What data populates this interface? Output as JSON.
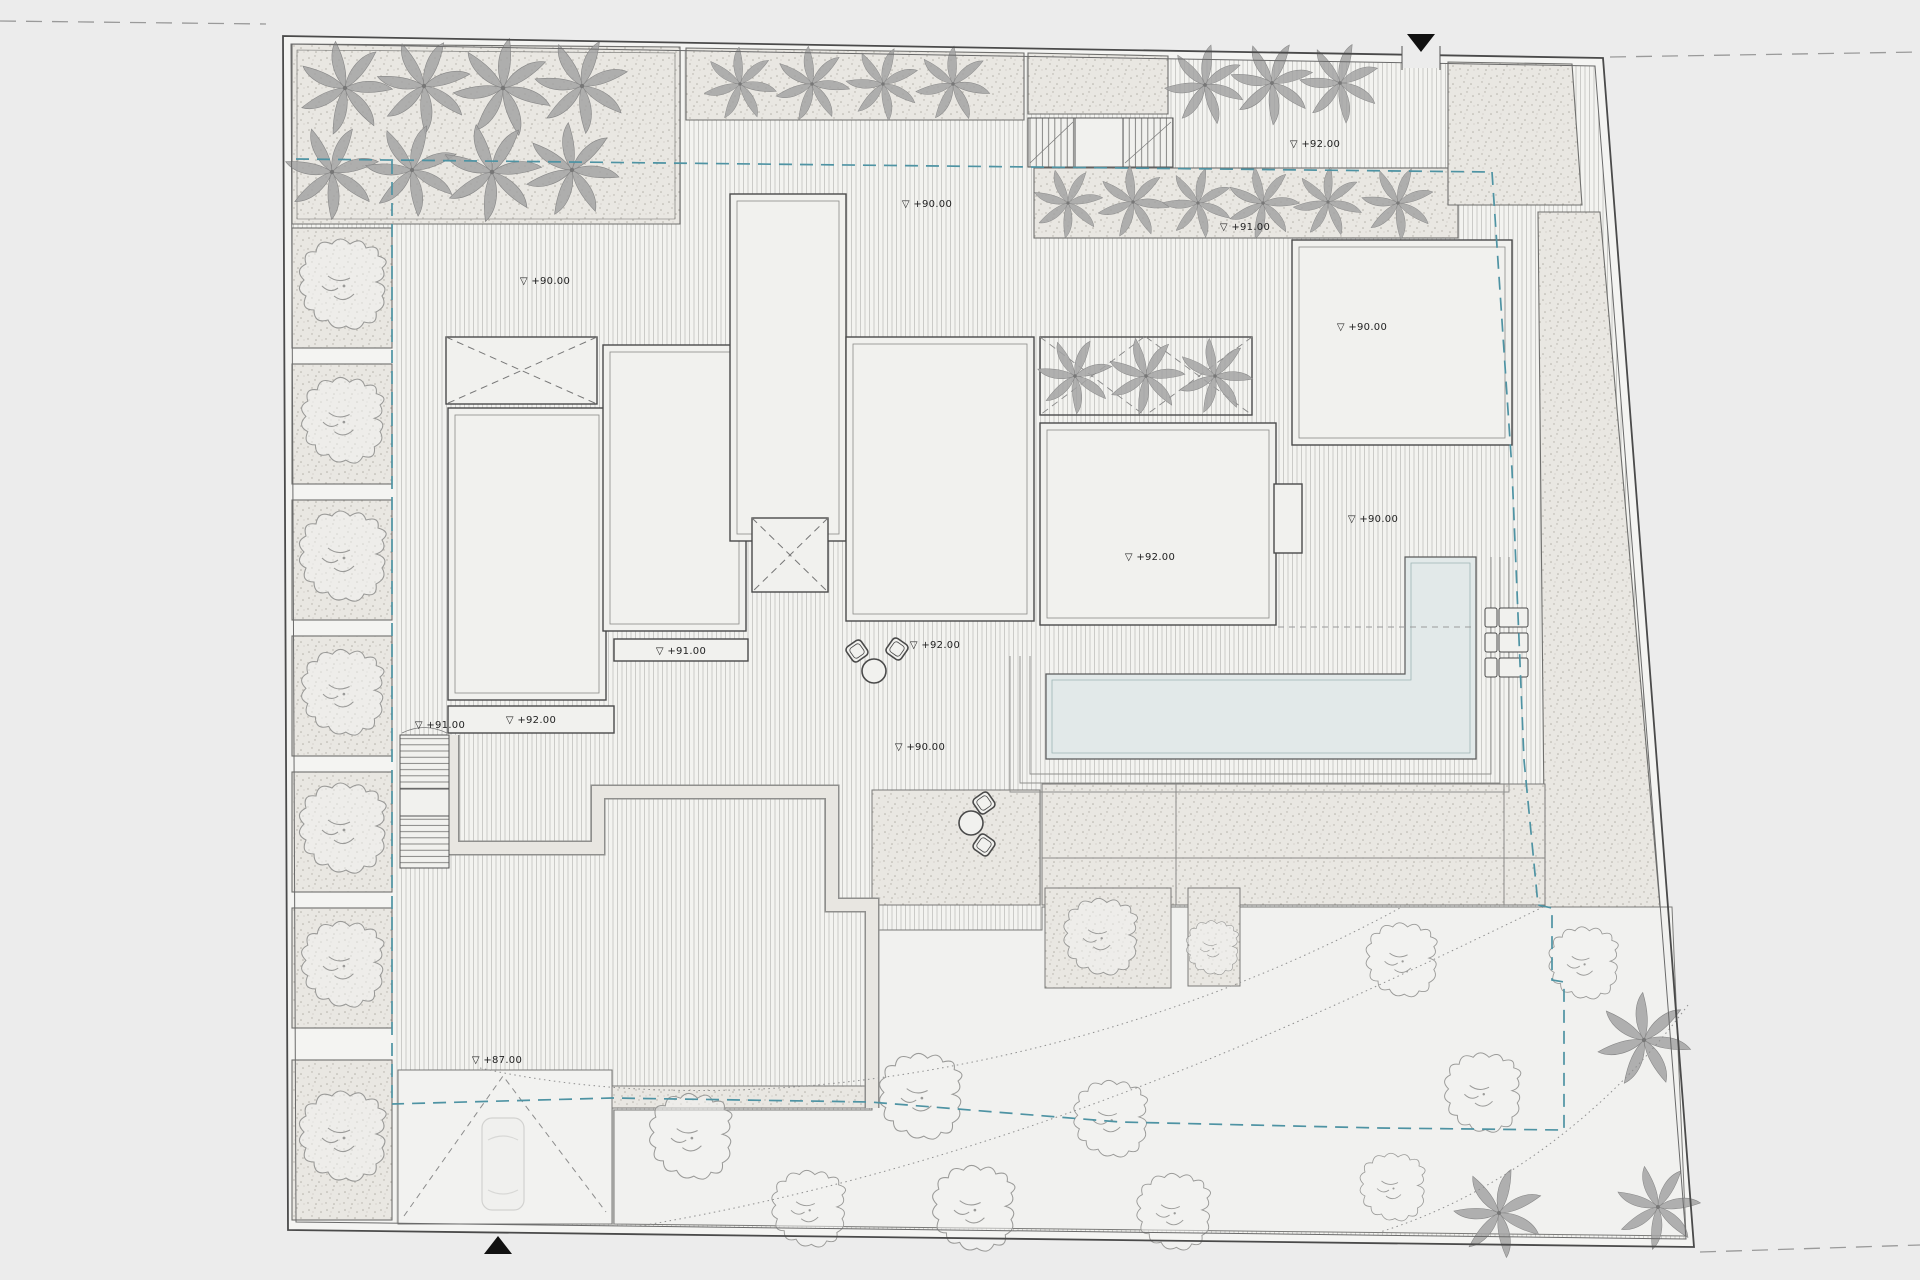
{
  "document": {
    "title": "Site Plan — Roof Level",
    "background": "#ececec"
  },
  "colors": {
    "paper": "#ececec",
    "site": "#f4f4f2",
    "hatch_line": "#c7c7c4",
    "stipple_bg": "#e9e7e2",
    "stipple_dot": "#b3b0a8",
    "roof": "#f1f1ee",
    "line_dark": "#4a4a4a",
    "line_mid": "#8a8a88",
    "pool_water": "#e2e9e9",
    "setback_teal": "#4e93a3",
    "street_dash": "#9a9a9a",
    "marker_black": "#111111"
  },
  "markers": {
    "north_entry": "▼",
    "south_entry": "▲"
  },
  "level_markers": [
    {
      "x": 545,
      "y": 284,
      "text": "▽ +90.00"
    },
    {
      "x": 927,
      "y": 207,
      "text": "▽ +90.00"
    },
    {
      "x": 1315,
      "y": 147,
      "text": "▽ +92.00"
    },
    {
      "x": 1245,
      "y": 230,
      "text": "▽ +91.00"
    },
    {
      "x": 1362,
      "y": 330,
      "text": "▽ +90.00"
    },
    {
      "x": 531,
      "y": 723,
      "text": "▽ +92.00"
    },
    {
      "x": 681,
      "y": 654,
      "text": "▽ +91.00"
    },
    {
      "x": 935,
      "y": 648,
      "text": "▽ +92.00"
    },
    {
      "x": 1150,
      "y": 560,
      "text": "▽ +92.00"
    },
    {
      "x": 1373,
      "y": 522,
      "text": "▽ +90.00"
    },
    {
      "x": 440,
      "y": 728,
      "text": "▽ +91.00"
    },
    {
      "x": 497,
      "y": 1063,
      "text": "▽ +87.00"
    },
    {
      "x": 920,
      "y": 750,
      "text": "▽ +90.00"
    }
  ],
  "vegetation": {
    "palm_count": 27,
    "tree_count": 19,
    "palms": [
      [
        345,
        88,
        1.0,
        10
      ],
      [
        424,
        86,
        1.0,
        200
      ],
      [
        503,
        88,
        1.05,
        80
      ],
      [
        582,
        86,
        1.0,
        300
      ],
      [
        332,
        172,
        1.0,
        150
      ],
      [
        412,
        170,
        0.98,
        40
      ],
      [
        492,
        172,
        1.05,
        260
      ],
      [
        572,
        170,
        1.0,
        120
      ],
      [
        740,
        84,
        0.78,
        20
      ],
      [
        812,
        84,
        0.8,
        170
      ],
      [
        883,
        84,
        0.78,
        90
      ],
      [
        953,
        84,
        0.8,
        280
      ],
      [
        1068,
        203,
        0.74,
        0
      ],
      [
        1133,
        202,
        0.77,
        120
      ],
      [
        1198,
        203,
        0.74,
        240
      ],
      [
        1263,
        203,
        0.77,
        60
      ],
      [
        1328,
        202,
        0.74,
        180
      ],
      [
        1398,
        203,
        0.77,
        300
      ],
      [
        1205,
        85,
        0.85,
        30
      ],
      [
        1272,
        83,
        0.88,
        200
      ],
      [
        1340,
        83,
        0.85,
        90
      ],
      [
        1075,
        376,
        0.8,
        45
      ],
      [
        1146,
        376,
        0.82,
        160
      ],
      [
        1215,
        376,
        0.8,
        270
      ],
      [
        1644,
        1040,
        1.0,
        20
      ],
      [
        1499,
        1213,
        0.95,
        140
      ],
      [
        1658,
        1207,
        0.9,
        260
      ]
    ],
    "trees": [
      [
        342,
        288,
        1.0
      ],
      [
        342,
        424,
        0.95
      ],
      [
        342,
        560,
        1.0
      ],
      [
        342,
        696,
        0.95
      ],
      [
        342,
        832,
        1.0
      ],
      [
        342,
        968,
        0.95
      ],
      [
        342,
        1140,
        1.0
      ],
      [
        1100,
        940,
        0.85
      ],
      [
        920,
        1100,
        0.95
      ],
      [
        1110,
        1122,
        0.85
      ],
      [
        690,
        1140,
        0.95
      ],
      [
        808,
        1212,
        0.85
      ],
      [
        973,
        1212,
        0.95
      ],
      [
        1173,
        1215,
        0.85
      ],
      [
        1583,
        966,
        0.8
      ],
      [
        1401,
        963,
        0.82
      ],
      [
        1482,
        1096,
        0.88
      ],
      [
        1392,
        1190,
        0.75
      ],
      [
        1212,
        950,
        0.6
      ]
    ]
  },
  "furniture": {
    "loungers": [
      [
        1485,
        608
      ],
      [
        1485,
        633
      ],
      [
        1485,
        658
      ]
    ],
    "dining_sets": [
      {
        "table": [
          874,
          671
        ],
        "chairs": [
          [
            857,
            651,
            -35
          ],
          [
            897,
            649,
            35
          ]
        ]
      },
      {
        "table": [
          971,
          823
        ],
        "chairs": [
          [
            984,
            803,
            55
          ],
          [
            984,
            845,
            125
          ]
        ]
      }
    ]
  },
  "features": {
    "site_boundary": "property boundary (double line)",
    "setback_line": "building setback (teal dashed)",
    "pool": "stepped swimming pool",
    "roofs": [
      "west-roof",
      "middle-roof",
      "tall-roof",
      "center-roof",
      "east-roof",
      "northeast-roof"
    ],
    "skylights": [
      "northwest-skylight",
      "central-skylight"
    ],
    "stairs": [
      "north-stair",
      "west-stair"
    ],
    "driveway": "south entry driveway with gate swing",
    "garden": "south garden with paths and trees"
  }
}
